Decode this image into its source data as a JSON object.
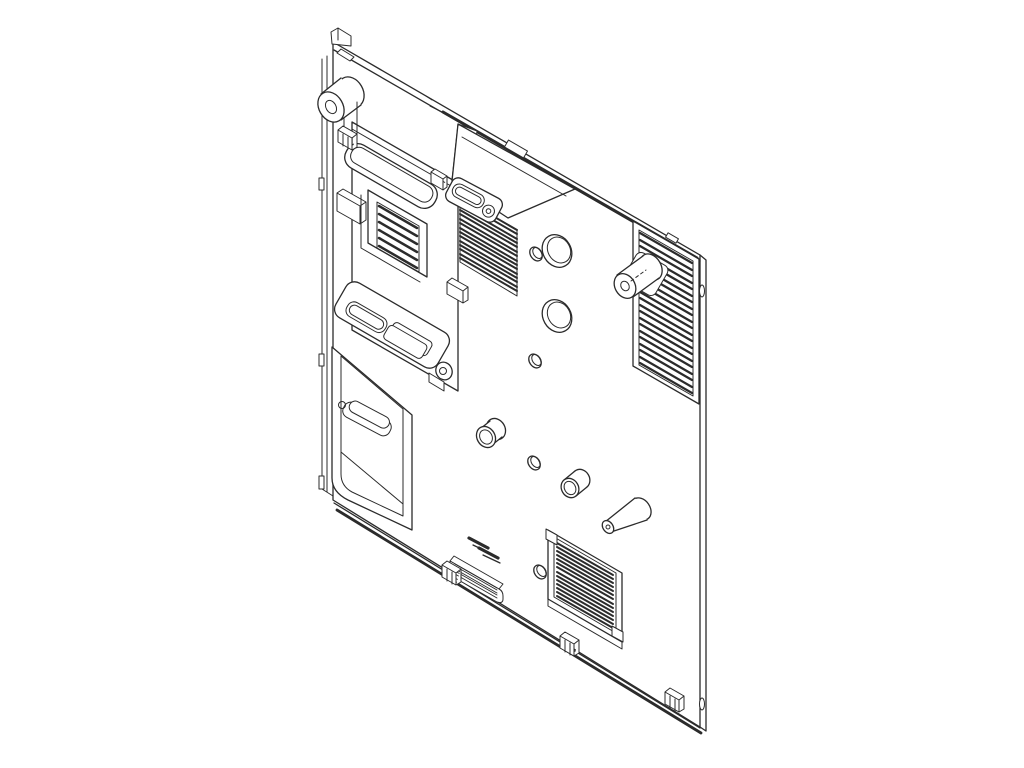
{
  "figure": {
    "description": "Black-and-white isometric CAD line drawing of a flat computer-chassis rear panel, drawn as a tilted parallelogram with its top and bottom edges sloping down to the right, on a plain white background",
    "background_color": "#ffffff",
    "line_color": "#2b2b2b",
    "fill_color": "#ffffff",
    "text_content": "none (only two tiny illegible embossed dash marks near the lower center of the panel)",
    "parts": [
      {
        "name": "panel-body",
        "desc": "flat sheet-metal panel, parallelogram silhouette with edge thickness lines"
      },
      {
        "name": "left-edge-flange",
        "desc": "thin folded flange strip along the left edge with small bumps"
      },
      {
        "name": "top-left-corner-tab",
        "desc": "small bent tab at the top-left corner"
      },
      {
        "name": "top-left-boss",
        "desc": "short fat cylindrical standoff protruding from the upper-left corner with mounting clip"
      },
      {
        "name": "upper-left-slot-emboss",
        "desc": "long rounded slot emboss (handle-like) near the top left"
      },
      {
        "name": "left-mount-plate",
        "desc": "large raised rectangular plate on the left half"
      },
      {
        "name": "small-vent-box",
        "desc": "raised box with six horizontal louver slats"
      },
      {
        "name": "lower-bar-emboss",
        "desc": "rounded bar emboss containing a slot cutout and a raised box"
      },
      {
        "name": "screw-boss",
        "desc": "small cylindrical screw boss with foot tab"
      },
      {
        "name": "recessed-tray",
        "desc": "large recessed tray at the lower left with inner slot and screw hole"
      },
      {
        "name": "latch-bracket",
        "desc": "wedge-shaped hood bracket with oval slot plate and screw, top middle"
      },
      {
        "name": "vent-grille-upper",
        "desc": "louvered vent field with about 15 slats, upper middle"
      },
      {
        "name": "vent-grille-right",
        "desc": "tall framed louvered vent with about 21 slats along the right edge, pierced by a cylindrical standoff"
      },
      {
        "name": "vent-grille-bottom",
        "desc": "square framed louvered vent with about 14 slats and corner pads, lower middle"
      },
      {
        "name": "mid-right-boss",
        "desc": "cylindrical standoff protruding through the right vent grille"
      },
      {
        "name": "cone-standoff",
        "desc": "conical standoff near the bottom grille"
      },
      {
        "name": "round-bosses",
        "desc": "two short cylindrical bosses in the middle field"
      },
      {
        "name": "ring-holes",
        "desc": "two large round holes with rim thickness"
      },
      {
        "name": "small-holes",
        "desc": "four small oval holes"
      },
      {
        "name": "bottom-connector",
        "desc": "small raised connector block with fine slats near bottom center"
      },
      {
        "name": "edge-clips",
        "desc": "three stepped retaining clips along the bottom edge"
      },
      {
        "name": "embossed-marks",
        "desc": "two tiny slanted embossed dash marks (illegible)"
      }
    ]
  }
}
